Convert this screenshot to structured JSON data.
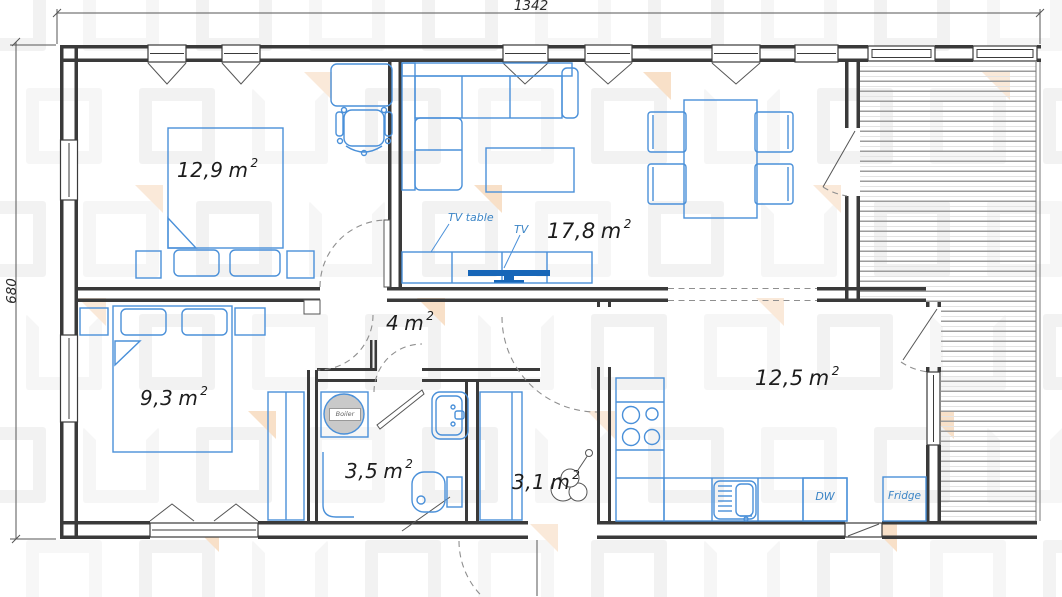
{
  "dimensions": {
    "width_label": "1342",
    "height_label": "680"
  },
  "unit": "m",
  "exp": "2",
  "rooms": [
    {
      "id": "bedroom-1",
      "area": "12,9"
    },
    {
      "id": "living-room",
      "area": "17,8"
    },
    {
      "id": "hallway",
      "area": "4"
    },
    {
      "id": "bedroom-2",
      "area": "9,3"
    },
    {
      "id": "bathroom",
      "area": "3,5"
    },
    {
      "id": "entry",
      "area": "3,1"
    },
    {
      "id": "kitchen",
      "area": "12,5"
    }
  ],
  "labels": {
    "tv_table": "TV table",
    "tv": "TV",
    "dw": "DW",
    "fridge": "Fridge",
    "boiler": "Boiler"
  },
  "colors": {
    "wall": "#3a3a3a",
    "furniture": "#4a90d9",
    "tv_fill": "#1766b8",
    "blue_label": "#3c85c6"
  }
}
